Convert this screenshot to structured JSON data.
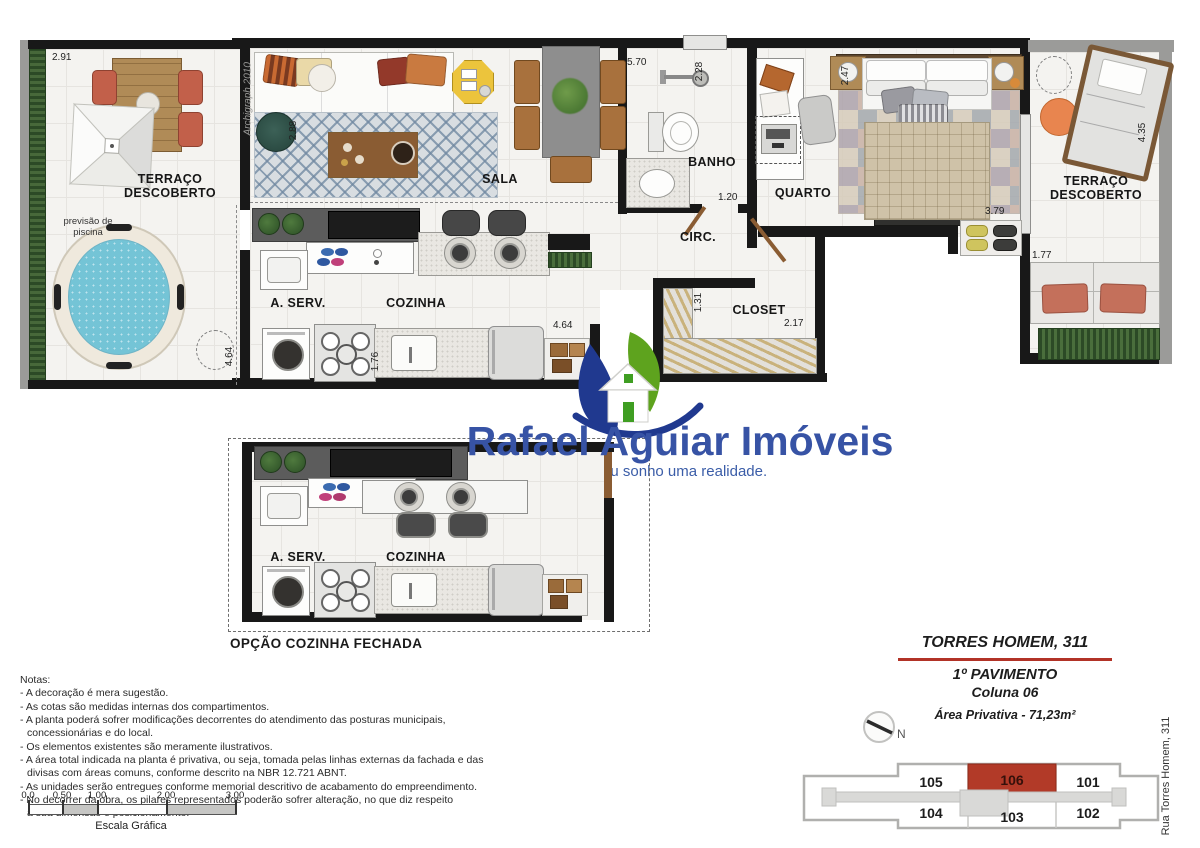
{
  "logo": {
    "name": "Rafael Aguiar Imóveis",
    "tagline": "Torne seu sonho uma realidade."
  },
  "plan": {
    "watermark": "Archigraph 2010",
    "rooms": {
      "terraco_left": "TERRAÇO\nDESCOBERTO",
      "sala": "SALA",
      "banho": "BANHO",
      "circ": "CIRC.",
      "quarto": "QUARTO",
      "closet": "CLOSET",
      "aserv": "A. SERV.",
      "cozinha": "COZINHA",
      "terraco_right": "TERRAÇO\nDESCOBERTO"
    },
    "pool_note": "previsão de\npiscina",
    "dims": {
      "terraco_left_width": "2.91",
      "terraco_left_depth": "4.64",
      "sala_depth": "2.88",
      "sala_width": "5.70",
      "banho_depth": "2.28",
      "banho_door": "1.20",
      "quarto_width": "2.47",
      "closet_depth": "1.31",
      "closet_width": "2.17",
      "quarto_length": "3.79",
      "terraco_right_depth": "4.35",
      "terraco_right_bench": "1.77",
      "cozinha_length": "4.64",
      "cozinha_sink": "1.76"
    },
    "option": {
      "label": "OPÇÃO COZINHA FECHADA",
      "aserv": "A. SERV.",
      "cozinha": "COZINHA"
    }
  },
  "notes": {
    "title": "Notas:",
    "lines": [
      "- A decoração é mera sugestão.",
      "- As cotas são medidas internas dos compartimentos.",
      "- A planta poderá sofrer modificações decorrentes do atendimento das posturas municipais,",
      "concessionárias e do local.",
      "- Os elementos existentes são meramente ilustrativos.",
      "- A área total indicada na planta é privativa, ou seja, tomada pelas linhas externas da fachada e das",
      "divisas com áreas comuns, conforme descrito na NBR 12.721 ABNT.",
      "- As unidades serão entregues conforme memorial descritivo de acabamento do empreendimento.",
      "- No decorrer da obra, os pilares representados poderão sofrer alteração, no que diz respeito",
      "a sua dimensão e posicionamento."
    ]
  },
  "scalebar": {
    "ticks": [
      "0.0",
      "0.50",
      "1.00",
      "2.00",
      "3.00"
    ],
    "label": "Escala Gráfica"
  },
  "info": {
    "building": "TORRES HOMEM, 311",
    "floor": "1º PAVIMENTO",
    "column": "Coluna 06",
    "area": "Área Privativa - 71,23m²",
    "north": "N",
    "street": "Rua Torres Homem, 311",
    "units": {
      "top": [
        "105",
        "106",
        "101"
      ],
      "bottom": [
        "104",
        "103",
        "102"
      ],
      "highlighted": "106"
    }
  },
  "colors": {
    "accent_red": "#b23327",
    "logo_blue": "#3753a5",
    "leaf_green": "#5ea31e",
    "leaf_blue": "#20398f"
  }
}
